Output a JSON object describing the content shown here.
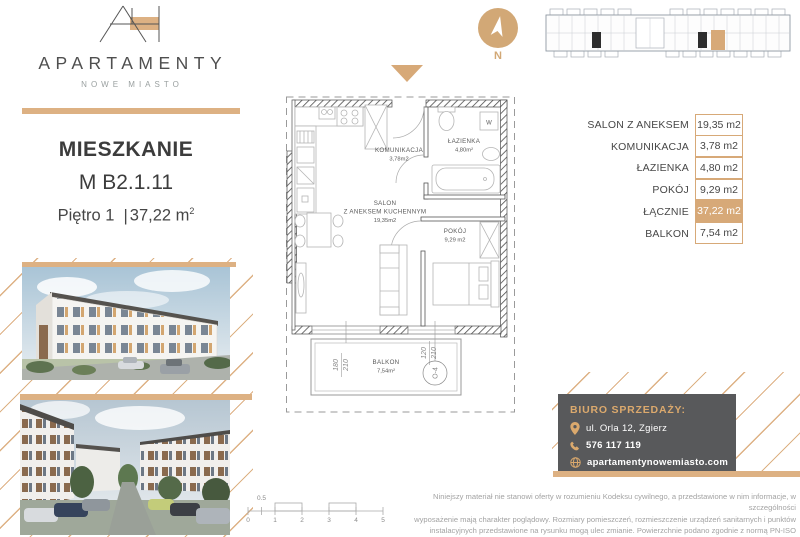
{
  "brand": {
    "name": "APARTAMENTY",
    "subtitle": "NOWE MIASTO"
  },
  "listing": {
    "heading": "MIESZKANIE",
    "unit": "M B2.1.11",
    "floor": "Piętro 1",
    "divider": "|",
    "area": "37,22 m",
    "area_exp": "2"
  },
  "compass": {
    "label": "N"
  },
  "plan": {
    "rooms": [
      {
        "name": "KOMUNIKACJA",
        "area": "3,78m2"
      },
      {
        "name": "ŁAZIENKA",
        "area": "4,80m²"
      },
      {
        "name": "SALON",
        "name2": "Z ANEKSEM KUCHENNYM",
        "area": "19,35m2"
      },
      {
        "name": "POKÓJ",
        "area": "9,29 m2"
      },
      {
        "name": "BALKON",
        "area": "7,54m²"
      }
    ],
    "washer_label": "W",
    "dimensions": [
      {
        "w": "180",
        "h": "210"
      },
      {
        "w": "120",
        "h": "210"
      }
    ],
    "window_ref": "O-4"
  },
  "area_table": {
    "rows": [
      {
        "label": "SALON Z ANEKSEM",
        "value": "19,35 m2",
        "highlight": false
      },
      {
        "label": "KOMUNIKACJA",
        "value": "3,78 m2",
        "highlight": false
      },
      {
        "label": "ŁAZIENKA",
        "value": "4,80 m2",
        "highlight": false
      },
      {
        "label": "POKÓJ",
        "value": "9,29 m2",
        "highlight": false
      },
      {
        "label": "ŁĄCZNIE",
        "value": "37,22 m2",
        "highlight": true
      },
      {
        "label": "BALKON",
        "value": "7,54 m2",
        "highlight": false
      }
    ]
  },
  "sales_office": {
    "title": "BIURO SPRZEDAŻY:",
    "address": "ul. Orla 12, Zgierz",
    "phone": "576 117 119",
    "website": "apartamentynowemiasto.com"
  },
  "disclaimer": {
    "line1": "Niniejszy materiał nie stanowi oferty w rozumieniu Kodeksu cywilnego, a przedstawione w nim informacje, w szczególności",
    "line2": "wyposażenie mają charakter poglądowy. Rozmiary pomieszczeń, rozmieszczenie urządzeń sanitarnych i punktów",
    "line3": "instalacyjnych przedstawione na rysunku mogą ulec zmianie. Powierzchnie podano zgodnie z normą PN-ISO 9836:2022.07."
  },
  "scale_bar": {
    "ticks": [
      "0",
      "1",
      "2",
      "3",
      "4",
      "5"
    ],
    "half": "0.5"
  },
  "colors": {
    "accent": "#d7a978",
    "dark_box": "#58595b",
    "text_dark": "#3f3f40",
    "muted": "#a3a3a3"
  }
}
